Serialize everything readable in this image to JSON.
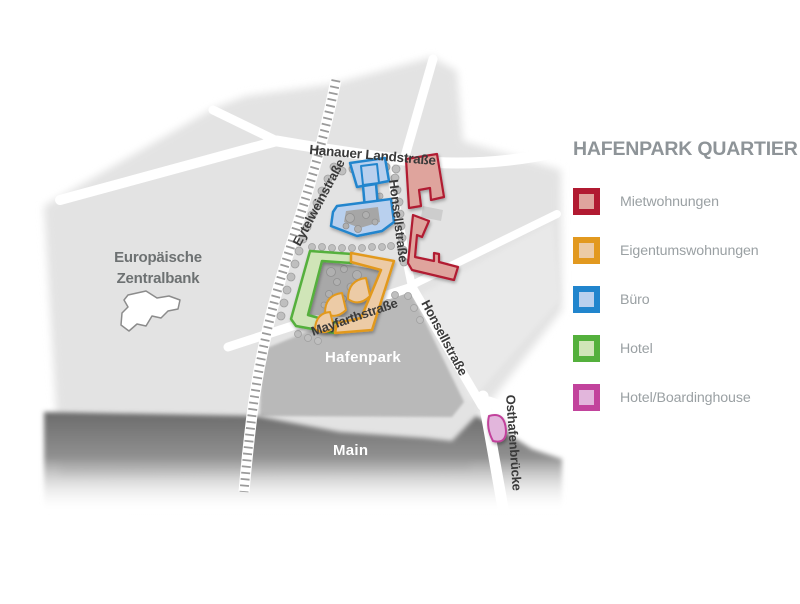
{
  "legend": {
    "title": "HAFENPARK QUARTIER",
    "items": [
      {
        "key": "miet",
        "label": "Mietwohnungen",
        "border": "#b11a31",
        "fill": "#dfa49d"
      },
      {
        "key": "eigentum",
        "label": "Eigentumswohnungen",
        "border": "#e2991f",
        "fill": "#eccba6"
      },
      {
        "key": "buero",
        "label": "Büro",
        "border": "#2185cd",
        "fill": "#b9d0ee"
      },
      {
        "key": "hotel",
        "label": "Hotel",
        "border": "#54b03c",
        "fill": "#d0e5b8"
      },
      {
        "key": "boarding",
        "label": "Hotel/Boardinghouse",
        "border": "#c2439c",
        "fill": "#e2b6dc"
      }
    ]
  },
  "map": {
    "streets": {
      "hanauer_landstrasse": "Hanauer Landstraße",
      "eytelweinstrasse": "Eytelweinstraße",
      "honsellstrasse_upper": "Honsellstraße",
      "honsellstrasse_lower": "Honsellstraße",
      "mayfarthstrasse": "Mayfarthstraße",
      "osthafenbruecke": "Osthafenbrücke"
    },
    "labels": {
      "hafenpark": "Hafenpark",
      "main": "Main",
      "ecb_line1": "Europäische",
      "ecb_line2": "Zentralbank"
    }
  }
}
